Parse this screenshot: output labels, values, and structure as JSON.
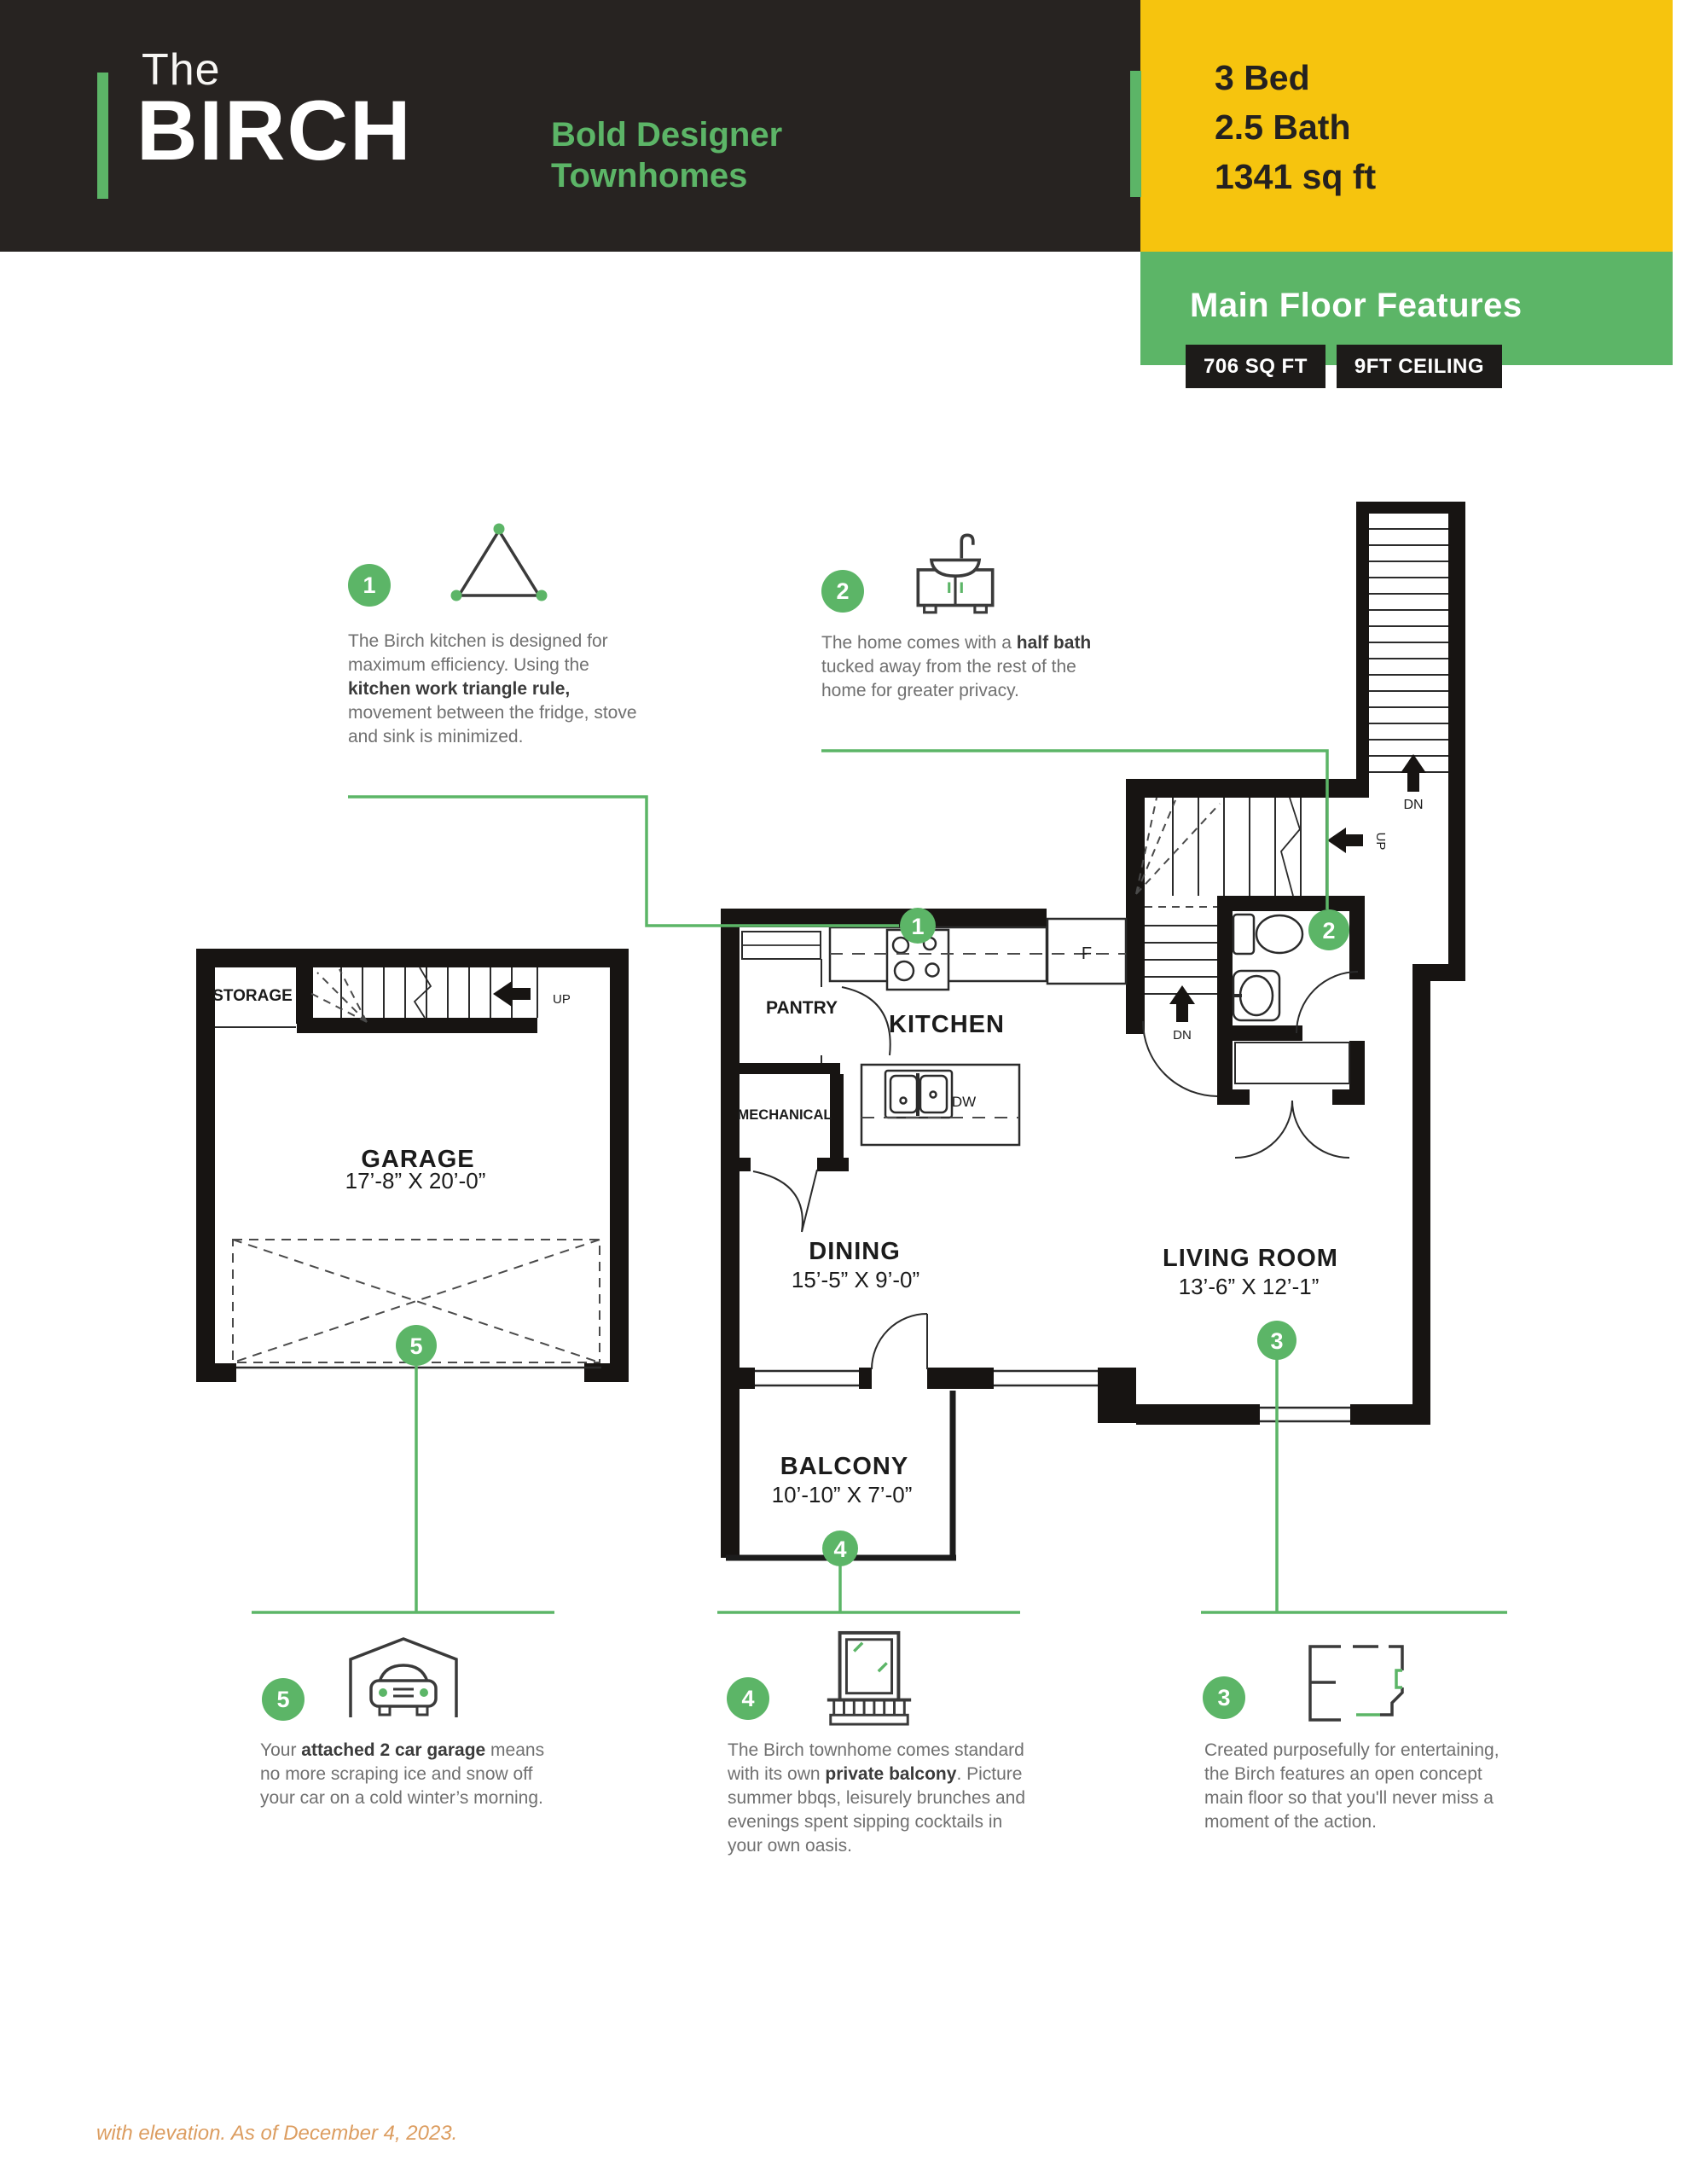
{
  "colors": {
    "green": "#5cb567",
    "yellow": "#f6c40e",
    "dark": "#272321",
    "badge_dark": "#1d1b19",
    "footer_orange": "#dc9d60"
  },
  "header": {
    "brand_prefix": "The",
    "brand_name": "BIRCH",
    "tagline_line1": "Bold Designer",
    "tagline_line2": "Townhomes",
    "spec_bed": "3 Bed",
    "spec_bath": "2.5 Bath",
    "spec_sqft": "1341 sq ft"
  },
  "panel": {
    "title": "Main Floor Features",
    "badge_sqft": "706 SQ FT",
    "badge_ceiling": "9FT CEILING"
  },
  "callouts": {
    "c1": {
      "num": "1",
      "icon": "work-triangle-icon",
      "pre": "The Birch kitchen is designed for maximum efficiency. Using the ",
      "bold": "kitchen work triangle rule,",
      "post": " movement between the fridge, stove and sink is minimized."
    },
    "c2": {
      "num": "2",
      "icon": "half-bath-sink-icon",
      "pre": " The home comes with a ",
      "bold": "half bath",
      "post": " tucked away from the rest of the home for greater privacy."
    },
    "c3": {
      "num": "3",
      "icon": "open-floorplan-icon",
      "pre": "Created purposefully for entertaining, the Birch features an open concept main floor so that you'll never miss a moment of the action.",
      "bold": "",
      "post": ""
    },
    "c4": {
      "num": "4",
      "icon": "balcony-icon",
      "pre": "The Birch townhome comes standard with its own ",
      "bold": "private balcony",
      "post": ". Picture summer bbqs, leisurely brunches and evenings spent sipping cocktails in your own oasis."
    },
    "c5": {
      "num": "5",
      "icon": "garage-car-icon",
      "pre": "Your ",
      "bold": "attached 2 car garage",
      "post": " means no more scraping ice and snow off your car on a cold winter’s morning."
    }
  },
  "plan": {
    "rooms": {
      "storage": "STORAGE",
      "garage": "GARAGE",
      "garage_dim": "17’-8” X 20’-0”",
      "pantry": "PANTRY",
      "mechanical": "MECHANICAL",
      "kitchen": "KITCHEN",
      "dining": "DINING",
      "dining_dim": "15’-5” X 9’-0”",
      "living": "LIVING ROOM",
      "living_dim": "13’-6” X 12’-1”",
      "balcony": "BALCONY",
      "balcony_dim": "10’-10” X 7’-0”"
    },
    "fixtures": {
      "fridge": "F",
      "dishwasher": "DW"
    },
    "stairs": {
      "up_main": "UP",
      "up_garage": "UP",
      "dn_upper": "DN",
      "dn_lower": "DN"
    },
    "markers": {
      "m1": "1",
      "m2": "2",
      "m3": "3",
      "m4": "4",
      "m5": "5"
    }
  },
  "footer": {
    "note": "with elevation. As of December 4, 2023."
  }
}
